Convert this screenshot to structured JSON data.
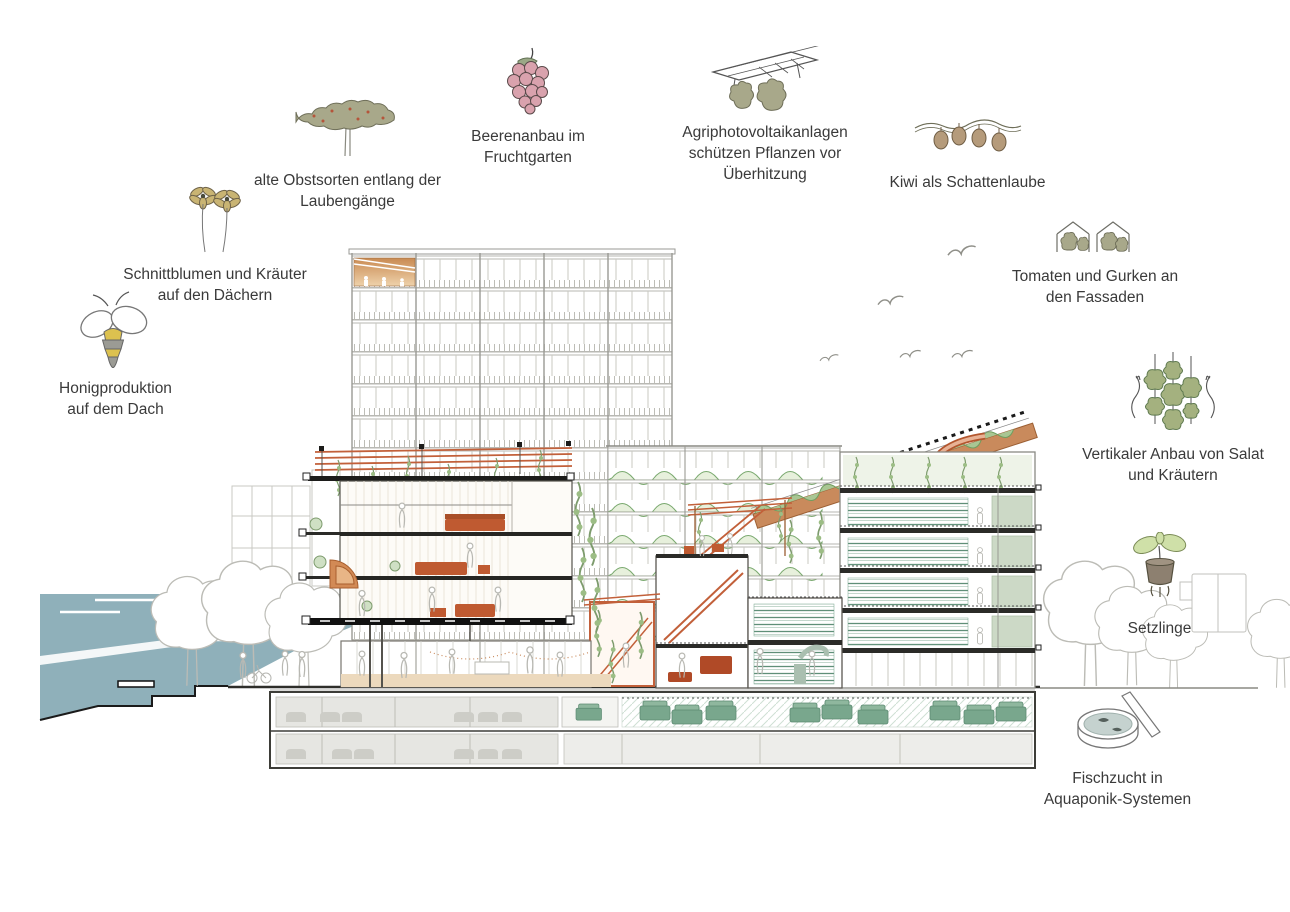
{
  "title": "Urban-farming building section illustration",
  "annotations": [
    {
      "id": "old-fruit-varieties",
      "icon": "fruit-tree-icon",
      "lines": [
        "alte Obstsorten entlang der",
        "Laubengänge"
      ]
    },
    {
      "id": "berry-cultivation",
      "icon": "berry-icon",
      "lines": [
        "Beerenanbau im",
        "Fruchtgarten"
      ]
    },
    {
      "id": "agri-photovoltaics",
      "icon": "solar-panel-trees-icon",
      "lines": [
        "Agriphotovoltaikanlagen",
        "schützen Pflanzen vor",
        "Überhitzung"
      ]
    },
    {
      "id": "kiwi-shade-arbor",
      "icon": "kiwi-vine-icon",
      "lines": [
        "Kiwi als Schattenlaube"
      ]
    },
    {
      "id": "cut-flowers-herbs",
      "icon": "cut-flowers-icon",
      "lines": [
        "Schnittblumen und Kräuter",
        "auf den Dächern"
      ]
    },
    {
      "id": "tomatoes-cucumbers",
      "icon": "facade-greenhouse-icon",
      "lines": [
        "Tomaten und Gurken an",
        "den Fassaden"
      ]
    },
    {
      "id": "honey-production",
      "icon": "bee-icon",
      "lines": [
        "Honigproduktion",
        "auf dem Dach"
      ]
    },
    {
      "id": "vertical-growing",
      "icon": "vertical-plants-icon",
      "lines": [
        "Vertikaler Anbau von Salat",
        "und Kräutern"
      ]
    },
    {
      "id": "seedlings",
      "icon": "seedling-pot-icon",
      "lines": [
        "Setzlinge"
      ]
    },
    {
      "id": "fish-farming",
      "icon": "aquaponics-tank-icon",
      "lines": [
        "Fischzucht in",
        "Aquaponik-Systemen"
      ]
    }
  ],
  "colors": {
    "accent_orange": "#c2603a",
    "furniture_orange": "#bf5a31",
    "plant_green": "#7d9b6d",
    "rack_green": "#5f8f78",
    "machine_green": "#79a78d",
    "sage_panel": "#ccd9c6",
    "water_blue": "#8fb0ba",
    "floor_tan": "#ecd9bd",
    "berry_pink": "#d9a2ad",
    "olive_foliage": "#a8a88a",
    "bee_yellow": "#dcc14f",
    "line_gray": "#a5a59e"
  }
}
